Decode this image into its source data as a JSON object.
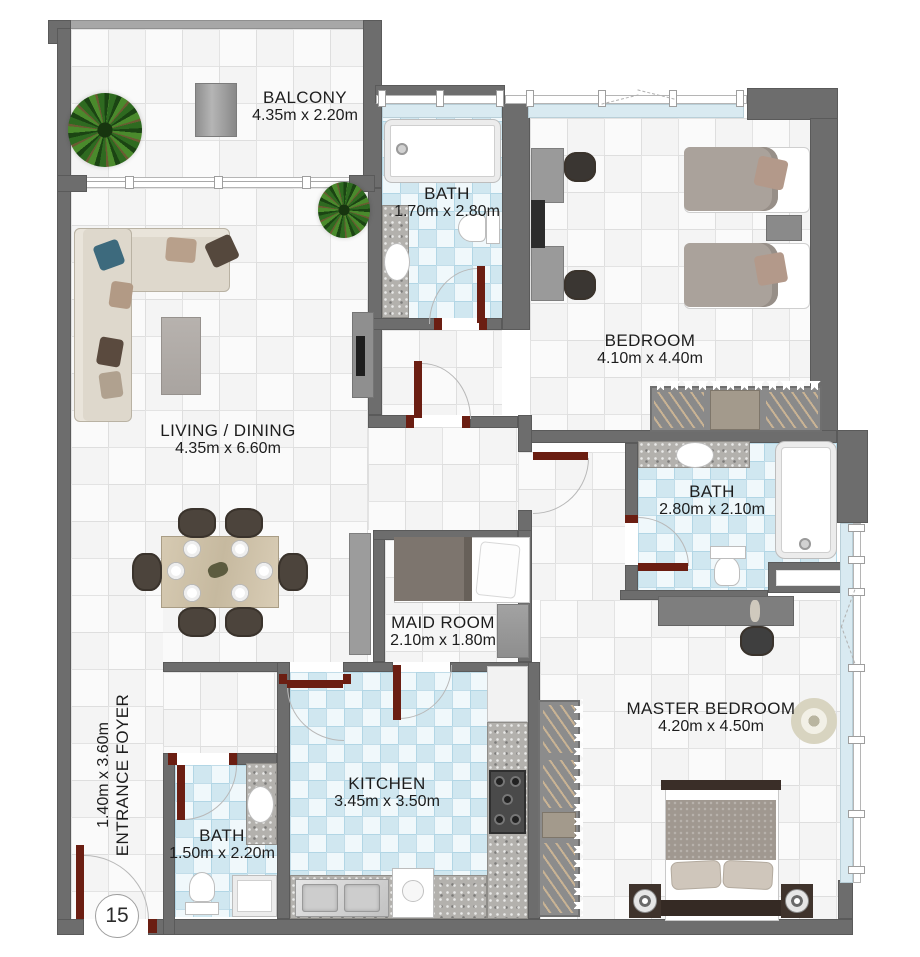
{
  "plan": {
    "title": "Apartment floor plan",
    "unit_number": "15",
    "rooms": {
      "balcony": {
        "name": "BALCONY",
        "dims": "4.35m x 2.20m"
      },
      "bath_top": {
        "name": "BATH",
        "dims": "1.70m x 2.80m"
      },
      "bedroom": {
        "name": "BEDROOM",
        "dims": "4.10m x 4.40m"
      },
      "living_dining": {
        "name": "LIVING / DINING",
        "dims": "4.35m x 6.60m"
      },
      "bath_ensuite": {
        "name": "BATH",
        "dims": "2.80m x 2.10m"
      },
      "maid_room": {
        "name": "MAID ROOM",
        "dims": "2.10m x 1.80m"
      },
      "master_bedroom": {
        "name": "MASTER BEDROOM",
        "dims": "4.20m x 4.50m"
      },
      "kitchen": {
        "name": "KITCHEN",
        "dims": "3.45m x 3.50m"
      },
      "bath_guest": {
        "name": "BATH",
        "dims": "1.50m x 2.20m"
      },
      "entrance_foyer": {
        "name": "ENTRANCE FOYER",
        "dims": "1.40m x 3.60m"
      }
    },
    "colors": {
      "wall": "#6d6d6d",
      "parapet": "#a7a7a7",
      "window_glass": "#d9eaf1",
      "door_leaf": "#6b1e12",
      "bath_tile": "#d8ecf4",
      "label_text": "#1d1d1d"
    }
  }
}
